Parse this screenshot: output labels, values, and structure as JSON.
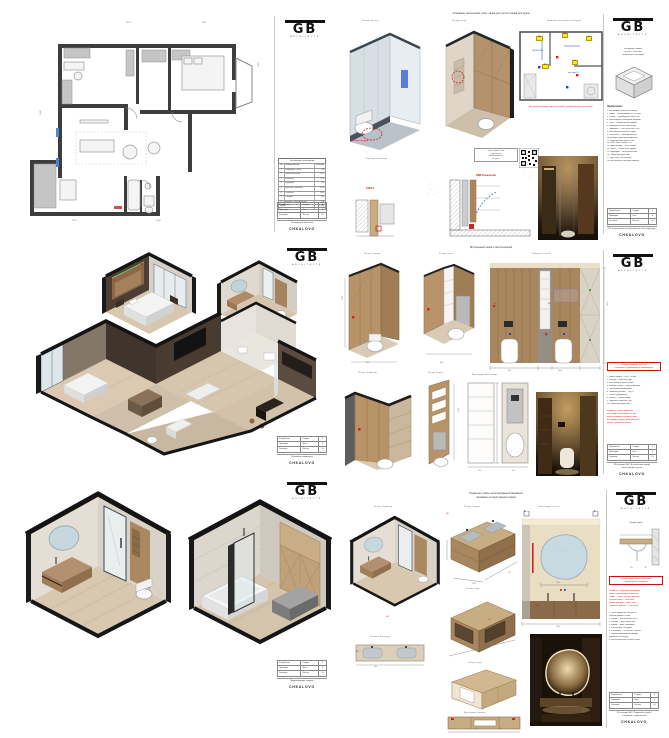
{
  "project": {
    "name": "CHKALOVO",
    "logo_main": "GB",
    "logo_sub": "ARCHITECTS"
  },
  "colors": {
    "accent_red": "#cc1111",
    "highlight_yellow": "#ffe32e",
    "blue": "#2233bb",
    "wood": "#a8875f",
    "beige": "#d9d3c6",
    "glass": "#dfe9f0",
    "wall_dark": "#3d3d3d"
  },
  "titleblock": {
    "rows": [
      {
        "l": "Разработал",
        "k": "Стадия",
        "v": "Р"
      },
      {
        "l": "Проверил",
        "k": "Лист",
        "v": "6"
      },
      {
        "l": "Заказчик",
        "k": "Листов",
        "v": "10"
      }
    ]
  },
  "s1": {
    "sheet_name": "Планировка мебелью",
    "schedule": {
      "title": "Экспликация помещений",
      "col_num": "№",
      "col_name": "Наименование",
      "col_area": "Площадь",
      "rows": [
        {
          "n": "1",
          "name": "Прихожая / холл",
          "area": "5,6"
        },
        {
          "n": "2",
          "name": "Кухня-гостиная",
          "area": "16,7"
        },
        {
          "n": "3",
          "name": "Спальня",
          "area": "11,8"
        },
        {
          "n": "4",
          "name": "Гардероб",
          "area": "4,2"
        },
        {
          "n": "5",
          "name": "Детская / Кабинет",
          "area": "15,4"
        },
        {
          "n": "6",
          "name": "Спальня",
          "area": "10,5"
        },
        {
          "n": "7",
          "name": "Санузел",
          "area": "4,9"
        },
        {
          "n": "8",
          "name": "Ванная / Постирочная",
          "area": "6,6"
        }
      ],
      "total_label": "Итого:",
      "total": "75,7 м²"
    },
    "dims": {
      "d1": "3870",
      "d2": "4250",
      "d3": "6240",
      "d4": "1520",
      "d5": "2400",
      "d6": "900"
    }
  },
  "s2": {
    "title": "Основные технические узлы: шкаф для гостя и шкаф для душа",
    "v1_label": "3D вид, зеркало",
    "v2_label": "3D вид, сбоку",
    "plan_title": "Привязки сантехники и электрики",
    "plan_warning": "Все розетки и выводы воды согласовать с дизайнером до начала работ!",
    "yellow_labels": [
      "ТП-1",
      "В-1",
      "Р-2",
      "ТП-2",
      "Р-1"
    ],
    "blue_label_1": "ГВС/ХВС Ø16",
    "blue_label_2": "выв. воды 1/2",
    "red_marker": "Смеситель гиг. душа",
    "box_label": "Короб для инсталляции",
    "note_box_lines": [
      "Короб зашить ГКЛВ",
      "в два слоя по",
      "металлокаркасу,",
      "см. узел 2"
    ],
    "qr_caption": [
      "При возникновении",
      "вопросов по узлу —",
      "QR на видео-",
      "инструкцию"
    ],
    "pdf_label": "ПДФ Технология",
    "uzel_label": "УЗЕЛ 2",
    "section_labels": [
      "Профиль 20х20 мм",
      "Керамогранит 10 мм",
      "Клей С2ТЕ S1",
      "Подсистема ГКЛВ",
      "Профиль подсветки",
      "Демпферная лента"
    ],
    "column_caption": [
      "Инструкция к коробу",
      "из ЛДСП 18 мм при",
      "самостоятельной сборке"
    ],
    "notes_title": "Примечания:",
    "notes": [
      "1. Все размеры уточнять по месту.",
      "2. Короб — влагостойкий ГКЛ в 2 слоя.",
      "3. Плитка — керамогранит 600х1200.",
      "4. Швы затирать эпоксидной затиркой.",
      "5. Углы — алюминиевый профиль.",
      "6. Ревизионный люк 300х600 мм.",
      "7. Подсветка — LED лента 24В, IP65.",
      "8. Блок питания вынести в нишу.",
      "9. Смесители — скрытый монтаж.",
      "10. Выводы воды герметизировать.",
      "11. Гидроизоляция пола и стен.",
      "12. Уклон пола к трапу 1-2%.",
      "13. Двери шкафа — push-to-open.",
      "14. Полки — стекло 6 мм, кромка.",
      "15. Фурнитура — Blum или аналог.",
      "16. Зазоры фасадов 3 мм.",
      "17. Цвет ЛДСП согласовать.",
      "18. Монтаж после чистовой отделки."
    ],
    "contact": "По всем вопросам обращаться к конструктору"
  },
  "s3": {
    "sheet_name": "Объемная изометрия"
  },
  "s4": {
    "title": "Встроенный шкаф с инсталляцией",
    "v1_label": "3D вид. Спереди",
    "v2_label": "3D вид. Сбоку",
    "elev_label": "Развертка. Стена В",
    "v3_label": "3D вид. Общий вид",
    "v4_label": "3D вид. Разрез",
    "flat_label": "Вид спереди. Инсталляция",
    "purple_label": "вент. люк",
    "dims": {
      "h1": "2070",
      "h2": "2160",
      "w1": "900",
      "w2": "1000",
      "d1": "600",
      "d2": "450",
      "d3": "350",
      "d4": "170",
      "d5": "250",
      "d6": "520",
      "red1": "300",
      "red2": "230"
    },
    "warning": [
      "Размеры проверить по месту!",
      "Согласовать с дизайнером до производства!"
    ],
    "notes_black": [
      "1. Каркас шкафа — ЛДСП 18 мм.",
      "2. Фасады — МДФ шпон дуб.",
      "3. Инсталляция Geberit Duofix.",
      "4. Клавиша смыва — чёрная матовая.",
      "5. Люк ревизии за фасадом.",
      "6. Полки внутренние — ЛДСП.",
      "7. Петли с доводчиком.",
      "8. Цоколь — влагостойкий.",
      "9. Подсветка ниши LED 24В.",
      "10. Зазоры фасадов 3 мм."
    ],
    "notes_red": [
      "Внимание! Унитаз подвесной,",
      "ось вывода канализации 230 мм.",
      "Высота клавиши 1000 мм от пола.",
      "Все выводы закрыть фальшпанелью.",
      "Доступ к узлам обеспечить!"
    ],
    "bottom_name": [
      "3D санузел №1. Встроенный шкаф,",
      "инсталляция и узлы"
    ]
  },
  "s5": {
    "sheet_name": "Визуализация санузла"
  },
  "s6": {
    "title": [
      "Подвесная тумба с интегрированной раковиной",
      "основание из искусственного камня"
    ],
    "v1_label": "3D вид. Общий вид",
    "topview_label": "Раковина. Вид сверху",
    "isoA_label": "3D вид. Спереди",
    "isoB_label": "3D вид. Сзади",
    "isoC_label": "3D вид. Каркас",
    "front_label": "Вид спереди. Размеры",
    "elev_label": "Вид спереди. Стена Б",
    "section_label": "Разрез тумбы",
    "marker": "B",
    "mirror_note": [
      "Зеркало сложной",
      "формы с подсветкой",
      "по контуру"
    ],
    "dims": {
      "mirror": "1350",
      "total": "1400",
      "depth": "520",
      "h": "600",
      "sink": "460",
      "front": "900",
      "gap": "180",
      "red1": "590",
      "red2": "560",
      "sec1": "520",
      "sec2": "150"
    },
    "warning": [
      "Цвет фасадов и камня согласовать",
      "с дизайнером по образцам!"
    ],
    "notes_red": [
      "Раковина — искусственный камень,",
      "литая, с перегородкой и уклоном.",
      "Сифон — слим, скрытого монтажа.",
      "Донный клапан — click-clack.",
      "Кромки фасадов — ABS 1 мм.",
      "Подсветка зеркала — LED 3000К."
    ],
    "notes_black": [
      "1. Тумба подвесная, монтаж на",
      "скрытый крепёж к стене.",
      "2. Корпус — влагостойкая ЛДСП.",
      "3. Фасады — МДФ эмаль мат.",
      "4. Ящики — Blum Tandembox.",
      "5. Push-to-open, без ручек.",
      "6. Смесители — настенные, чёрные.",
      "7. Зеркало произвольной формы,",
      "подсветка по контуру.",
      "8. Высота монтажа 900 мм от пола."
    ],
    "bottom_name": [
      "3D санузел №2. Подвесная тумба",
      "и зеркало с подсветкой"
    ]
  }
}
